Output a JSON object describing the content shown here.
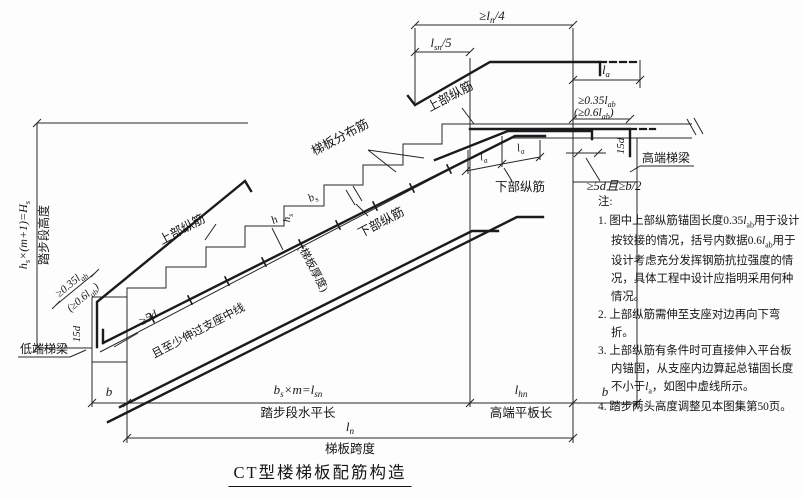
{
  "title": "CT型楼梯板配筋构造",
  "colors": {
    "line": "#26262a",
    "rebar": "#1b1b1e",
    "background": "#fdfdfd"
  },
  "notes": {
    "heading": "注:",
    "items": [
      "图中上部纵筋锚固长度0.35{lab}用于设计按铰接的情况，括号内数据0.6{lab}用于设计考虑充分发挥钢筋抗拉强度的情况，具体工程中设计应指明采用何种情况。",
      "上部纵筋需伸至支座对边再向下弯折。",
      "上部纵筋有条件时可直接伸入平台板内锚固，从支座内边算起总锚固长度不小于{la}，如图中虚线所示。",
      "踏步两头高度调整见本图集第50页。"
    ]
  },
  "figure": {
    "labels": [
      {
        "name": "dim-ln4",
        "text": "≥l~n~/4",
        "x": 492,
        "y": 20,
        "size": 13,
        "italic": true
      },
      {
        "name": "dim-lsn5",
        "text": "l~sn~/5",
        "x": 441,
        "y": 47,
        "size": 12.5,
        "italic": true
      },
      {
        "name": "dim-la-top",
        "text": "l~a~",
        "x": 606,
        "y": 74,
        "size": 12.5,
        "italic": true
      },
      {
        "name": "anchor-note-high-line1",
        "text": "≥0.35l~ab~",
        "x": 578,
        "y": 104,
        "size": 11.5,
        "italic": true,
        "anchor": "start"
      },
      {
        "name": "anchor-note-high-line2",
        "text": "(≥0.6l~ab~)",
        "x": 574,
        "y": 116,
        "size": 11.5,
        "italic": true,
        "anchor": "start"
      },
      {
        "name": "anchor-note-low-line1",
        "text": "≥0.35l~ab~",
        "x": 73,
        "y": 286,
        "rot": -40,
        "size": 11,
        "italic": true
      },
      {
        "name": "anchor-note-low-line2",
        "text": "(≥0.6l~ab~)",
        "x": 85,
        "y": 300,
        "rot": -40,
        "size": 11,
        "italic": true
      },
      {
        "name": "hook-15d-low",
        "text": "15d",
        "x": 80,
        "y": 334,
        "rot": -90,
        "size": 11,
        "italic": true
      },
      {
        "name": "hook-15d-high",
        "text": "15d",
        "x": 624,
        "y": 146,
        "rot": -90,
        "size": 11,
        "italic": true
      },
      {
        "name": "label-top-bars-low",
        "text": "上部纵筋",
        "x": 184,
        "y": 233,
        "rot": -28,
        "size": 12.5
      },
      {
        "name": "label-top-bars-high",
        "text": "上部纵筋",
        "x": 452,
        "y": 100,
        "rot": -28,
        "size": 12.5
      },
      {
        "name": "label-distribution-bars",
        "text": "梯板分布筋",
        "x": 342,
        "y": 141,
        "rot": -28,
        "size": 12.5
      },
      {
        "name": "label-bottom-bars-mid",
        "text": "下部纵筋",
        "x": 383,
        "y": 226,
        "rot": -28,
        "size": 12.5
      },
      {
        "name": "label-bottom-bars-right",
        "text": "下部纵筋",
        "x": 520,
        "y": 191,
        "size": 12.5
      },
      {
        "name": "dim-5d-b2",
        "text": "≥5d且≥b/2",
        "x": 614,
        "y": 190,
        "size": 12.5,
        "italic": true
      },
      {
        "name": "label-high-beam",
        "text": "高端梯梁",
        "x": 642,
        "y": 162,
        "size": 12,
        "anchor": "start"
      },
      {
        "name": "label-low-beam",
        "text": "低端梯梁",
        "x": 44,
        "y": 353,
        "size": 12
      },
      {
        "name": "dim-5d-low",
        "text": "≥5d",
        "x": 150,
        "y": 321,
        "rot": -28,
        "size": 12,
        "italic": true
      },
      {
        "name": "dim-past-support-center",
        "text": "且至少伸过支座中线",
        "x": 200,
        "y": 334,
        "rot": -28,
        "size": 11.5
      },
      {
        "name": "dim-height-formula",
        "text": "h~s~×(m+1)=H~s~",
        "x": 27,
        "y": 235,
        "rot": -90,
        "size": 12,
        "italic": true
      },
      {
        "name": "dim-height-name",
        "text": "踏步段高度",
        "x": 48,
        "y": 235,
        "rot": -90,
        "size": 12
      },
      {
        "name": "dim-b-left",
        "text": "b",
        "x": 109,
        "y": 396,
        "size": 13,
        "italic": true
      },
      {
        "name": "dim-bs-m-lsn",
        "text": "b~s~×m=l~sn~",
        "x": 298,
        "y": 394,
        "size": 13,
        "italic": true
      },
      {
        "name": "dim-tread-run",
        "text": "踏步段水平长",
        "x": 298,
        "y": 417,
        "size": 12.5
      },
      {
        "name": "dim-lhn",
        "text": "l~hn~",
        "x": 521,
        "y": 394,
        "size": 13,
        "italic": true
      },
      {
        "name": "dim-flat-run",
        "text": "高端平板长",
        "x": 521,
        "y": 417,
        "size": 12.5
      },
      {
        "name": "dim-b-right",
        "text": "b",
        "x": 605,
        "y": 396,
        "size": 13,
        "italic": true
      },
      {
        "name": "dim-ln",
        "text": "l~n~",
        "x": 350,
        "y": 431,
        "size": 13,
        "italic": true
      },
      {
        "name": "dim-span",
        "text": "梯板跨度",
        "x": 350,
        "y": 453,
        "size": 12.5
      },
      {
        "name": "dim-la-junction1",
        "text": "l~a~",
        "x": 484,
        "y": 160,
        "rot": -11,
        "size": 11,
        "italic": true
      },
      {
        "name": "dim-la-junction2",
        "text": "l~a~",
        "x": 521,
        "y": 151,
        "rot": -11,
        "size": 11,
        "italic": true
      },
      {
        "name": "dim-bs",
        "text": "b~s~",
        "x": 314,
        "y": 200,
        "rot": -28,
        "size": 11,
        "italic": true
      },
      {
        "name": "dim-hs",
        "text": "h~s~",
        "x": 290,
        "y": 218,
        "rot": -90,
        "size": 11,
        "italic": true
      },
      {
        "name": "dim-h",
        "text": "h",
        "x": 276,
        "y": 223,
        "rot": -28,
        "size": 11.5,
        "italic": true
      },
      {
        "name": "label-slab-thickness",
        "text": "(梯板厚度)",
        "x": 310,
        "y": 270,
        "rot": 62,
        "size": 11
      }
    ]
  }
}
